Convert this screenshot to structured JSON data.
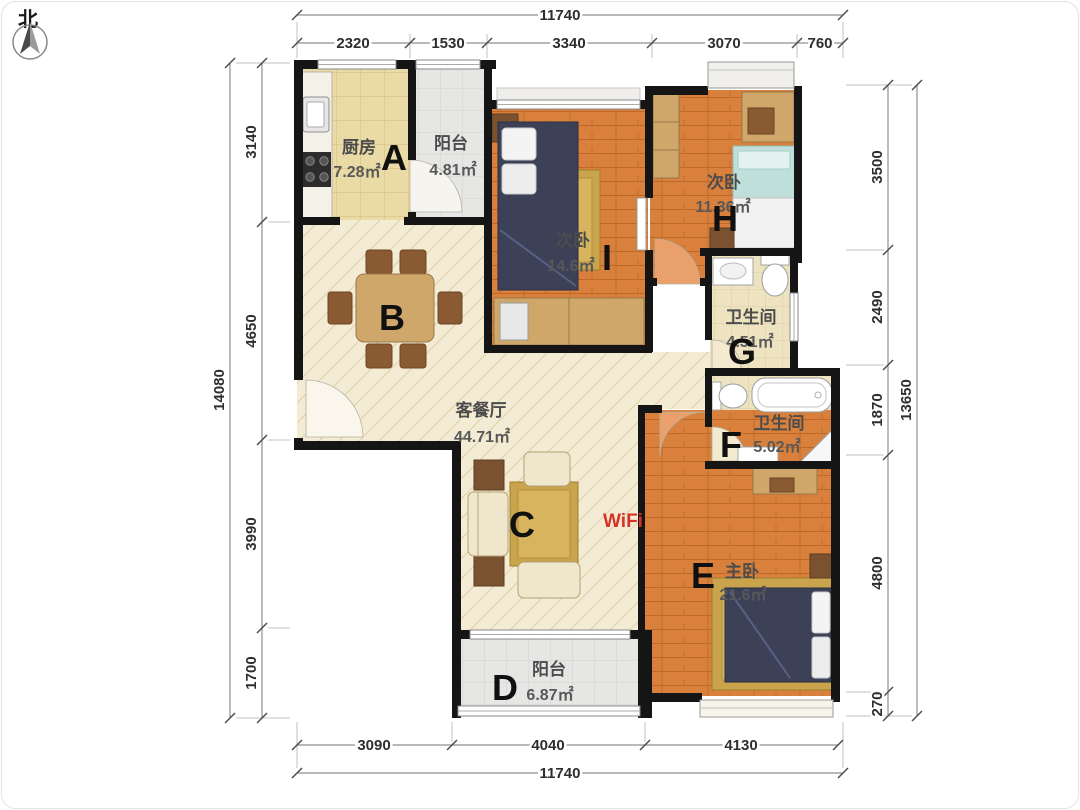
{
  "annotations": {
    "north": "北",
    "wifi": "WiFi"
  },
  "zones": {
    "a": "A",
    "b": "B",
    "c": "C",
    "d": "D",
    "e": "E",
    "f": "F",
    "g": "G",
    "h": "H",
    "i": "I"
  },
  "rooms": {
    "kitchen": {
      "name": "厨房",
      "area": "7.28㎡"
    },
    "balcony_top": {
      "name": "阳台",
      "area": "4.81㎡"
    },
    "bedroom_i": {
      "name": "次卧",
      "area": "14.6㎡"
    },
    "bedroom_h": {
      "name": "次卧",
      "area": "11.36㎡"
    },
    "bath_g": {
      "name": "卫生间",
      "area": "4.51㎡"
    },
    "bath_f": {
      "name": "卫生间",
      "area": "5.02㎡"
    },
    "living": {
      "name": "客餐厅",
      "area": "44.71㎡"
    },
    "master": {
      "name": "主卧",
      "area": "21.6㎡"
    },
    "balcony_bottom": {
      "name": "阳台",
      "area": "6.87㎡"
    }
  },
  "dimensions": {
    "top": {
      "total": "11740",
      "segments": [
        "2320",
        "1530",
        "3340",
        "3070",
        "760"
      ]
    },
    "bottom": {
      "total": "11740",
      "segments": [
        "3090",
        "4040",
        "4130"
      ]
    },
    "left": {
      "total": "14080",
      "segments": [
        "3140",
        "4650",
        "3990",
        "1700"
      ]
    },
    "right": {
      "total": "13650",
      "segments": [
        "3500",
        "2490",
        "1870",
        "4800",
        "270"
      ]
    }
  },
  "colors": {
    "wall": "#151515",
    "wood_floor": "#d8803c",
    "living_floor": "#f3ebd3",
    "kitchen_tile": "#eadaa5",
    "bath_tile": "#eee3c0",
    "balcony_gray": "#e6e6e4",
    "bed_navy": "#3c4158",
    "bed_teal": "#bfe0da",
    "rug_gold": "#c9a44c",
    "wifi_red": "#d93025"
  }
}
